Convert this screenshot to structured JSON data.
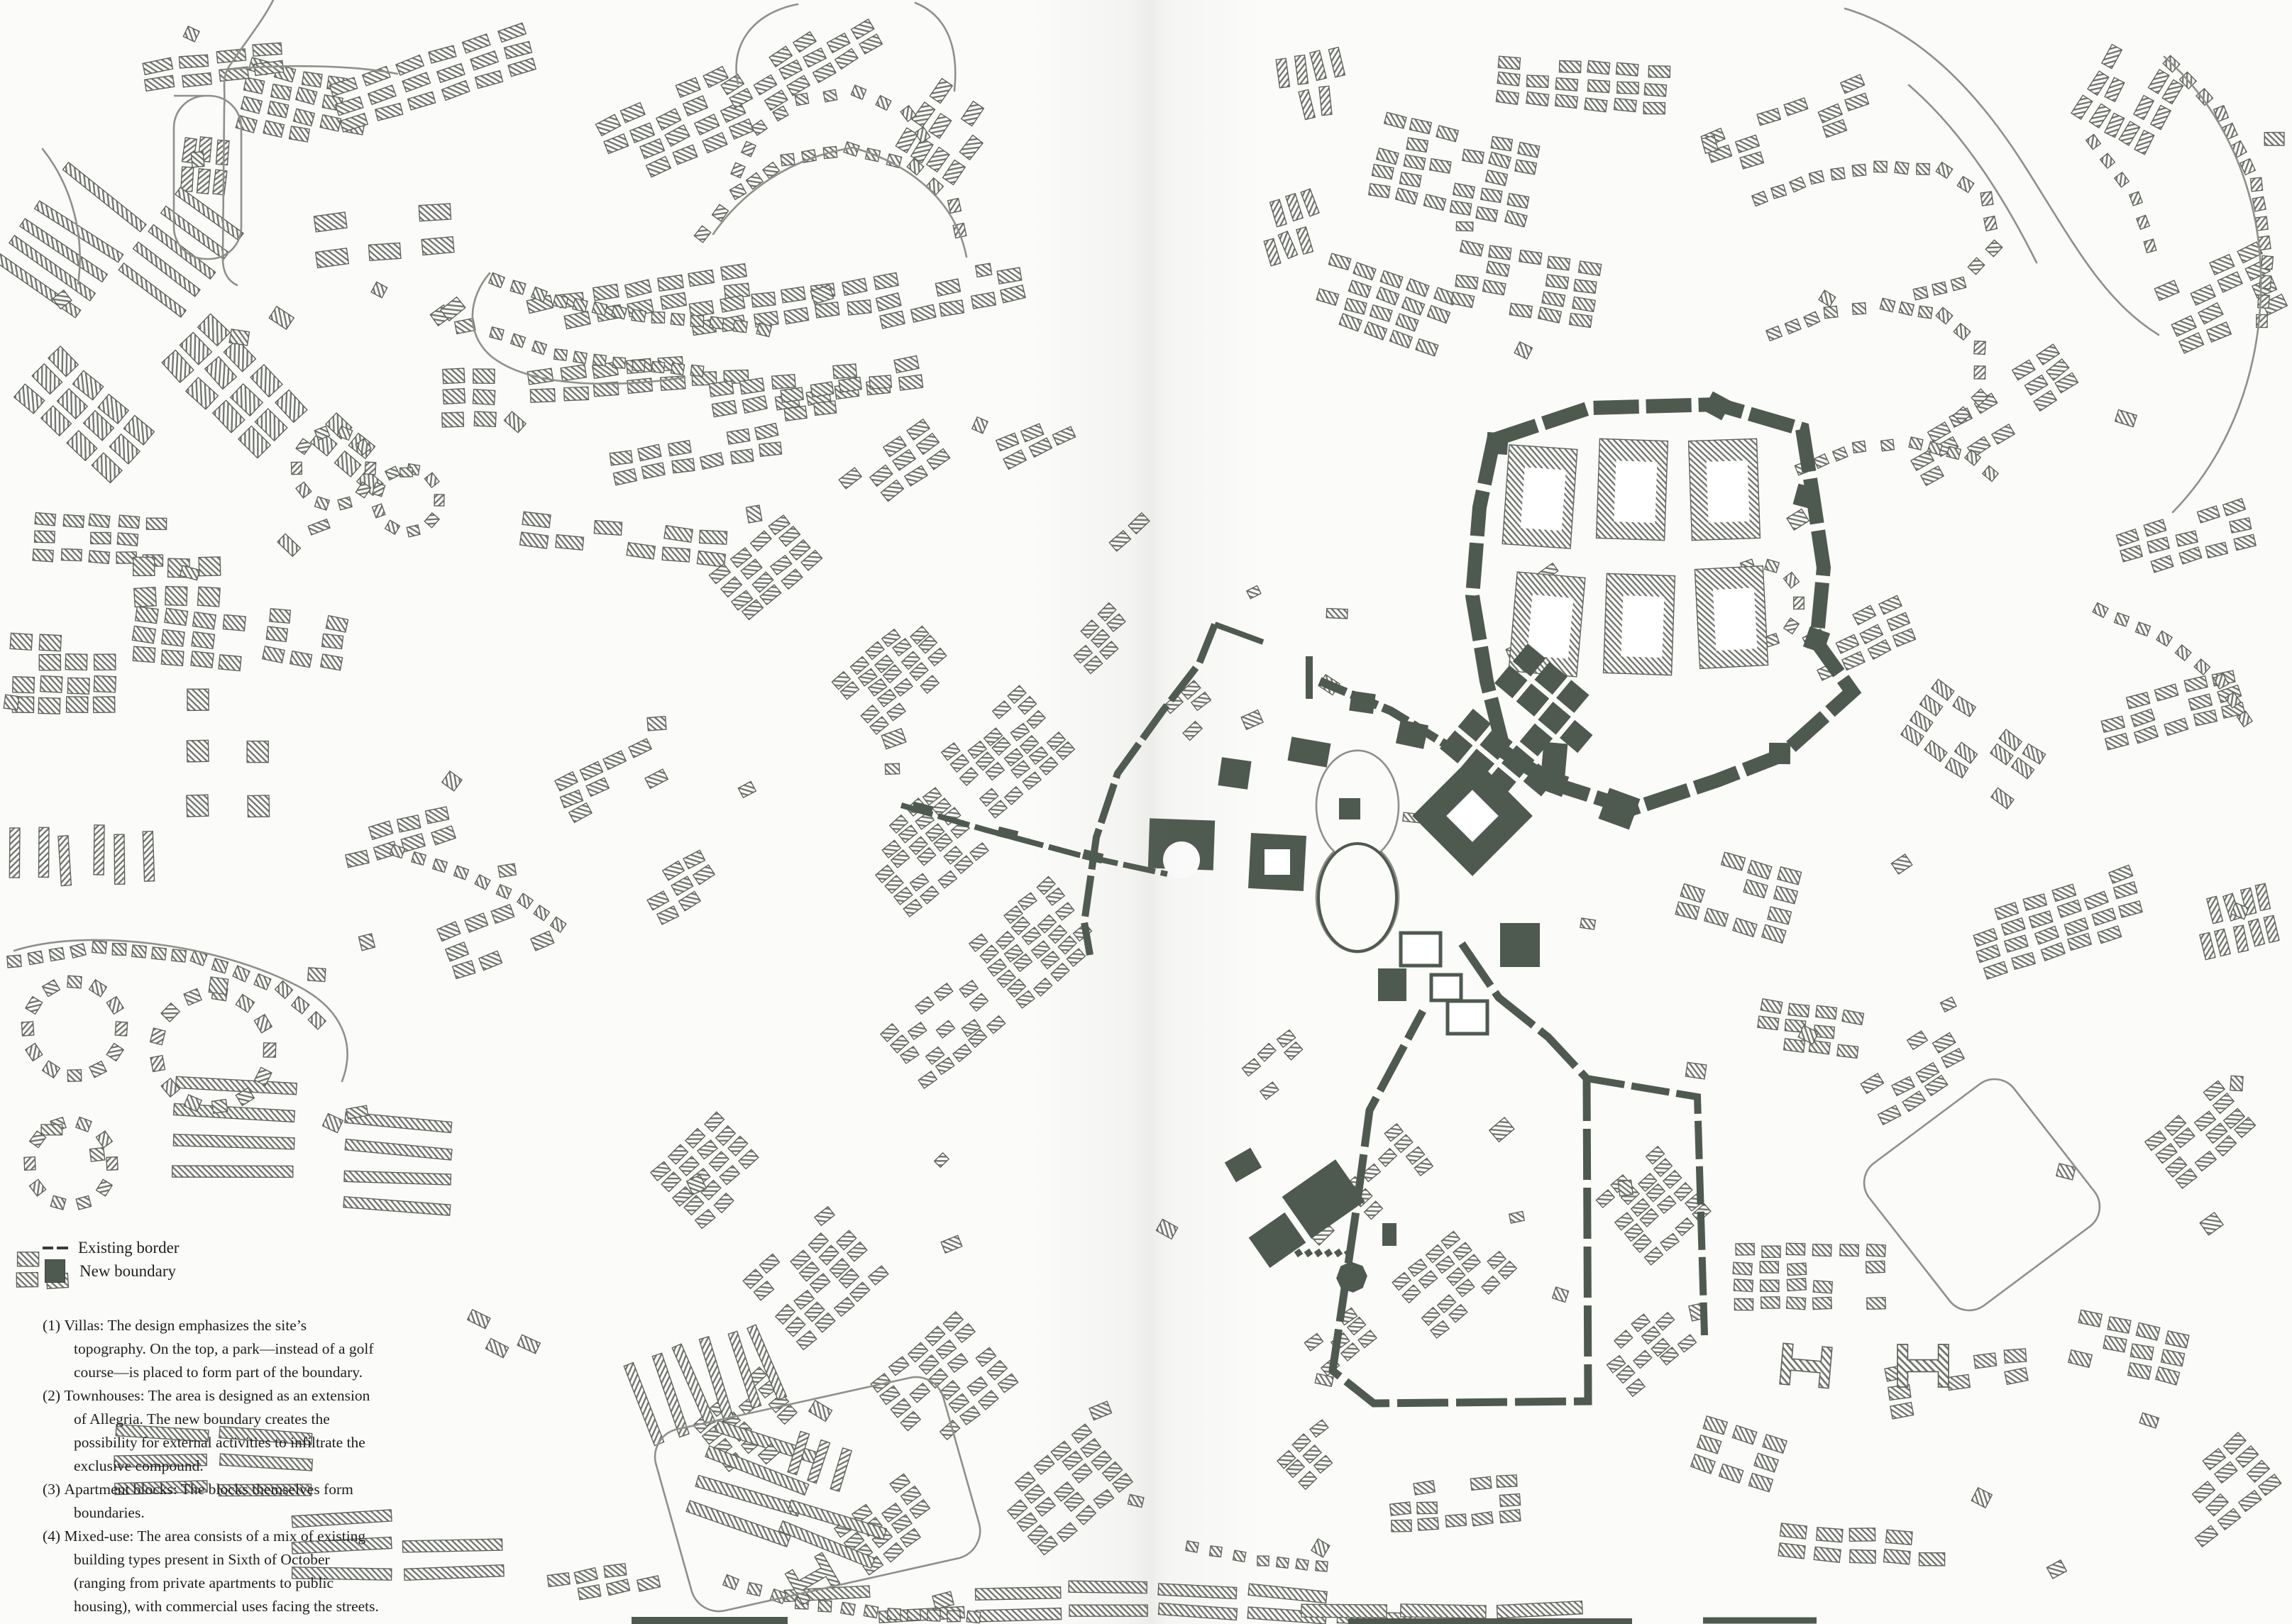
{
  "legend": {
    "items": [
      {
        "symbol": "existing-border-line",
        "label": "Existing border"
      },
      {
        "symbol": "new-boundary-square",
        "label": "New boundary"
      }
    ]
  },
  "notes": [
    {
      "num": "(1)",
      "text": "Villas: The design emphasizes the site’s topography. On the top, a park—instead of a golf course—is placed to form part of the boundary."
    },
    {
      "num": "(2)",
      "text": "Townhouses: The area is designed as an extension of Allegria. The new boundary creates the possibility for external activities to infiltrate the exclusive compound."
    },
    {
      "num": "(3)",
      "text": "Apartment blocks: The blocks themselves form boundaries."
    },
    {
      "num": "(4)",
      "text": "Mixed-use: The area consists of a mix of existing building types present in Sixth of October (ranging from private apartments to public housing), with commercial uses facing the streets."
    }
  ],
  "colors": {
    "paper": "#fbfbf9",
    "building_hatch": "#72766e",
    "building_outline": "#5f635c",
    "road_line": "#8f8f8b",
    "boundary_green": "#4e5a50",
    "text": "#202020"
  }
}
